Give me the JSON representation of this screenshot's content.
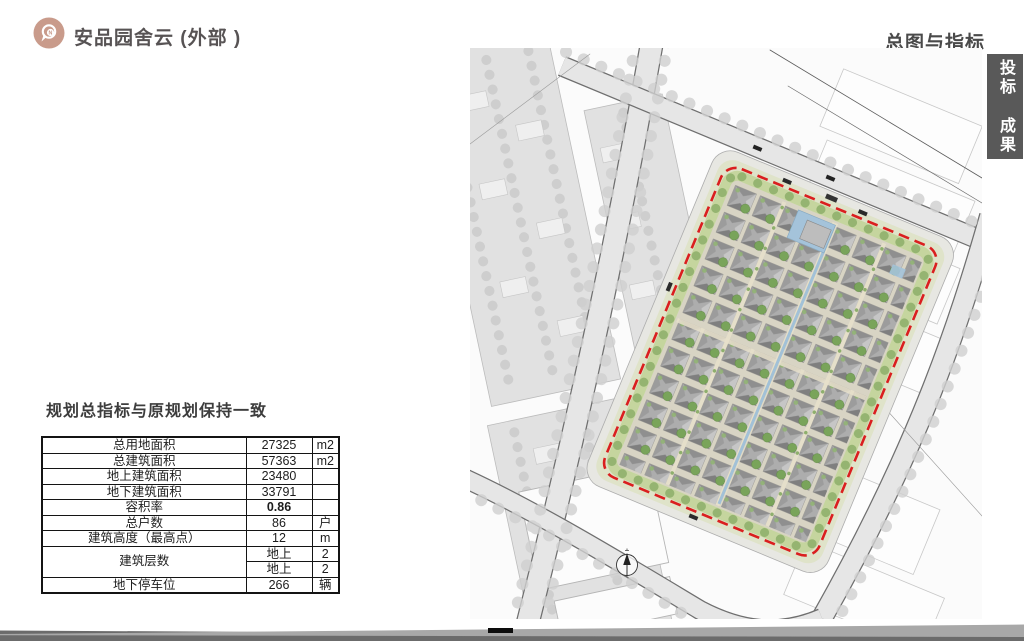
{
  "header": {
    "logo": {
      "icon": "location-pin-icon",
      "badge_letter": "N",
      "color": "#c99b8b"
    },
    "app_title": "安品园舍云 (外部 )",
    "section_title": "总图与指标",
    "side_tab": {
      "label": "投标 成果",
      "color": "#595959"
    }
  },
  "indicators": {
    "title": "规划总指标与原规划保持一致",
    "rows": [
      {
        "label": "总用地面积",
        "value": "27325",
        "unit": "m2"
      },
      {
        "label": "总建筑面积",
        "value": "57363",
        "unit": "m2"
      },
      {
        "label": "地上建筑面积",
        "value": "23480",
        "unit": ""
      },
      {
        "label": "地下建筑面积",
        "value": "33791",
        "unit": ""
      },
      {
        "label": "容积率",
        "value": "0.86",
        "unit": "",
        "bold": true
      },
      {
        "label": "总户数",
        "value": "86",
        "unit": "户"
      },
      {
        "label": "建筑高度（最高点）",
        "value": "12",
        "unit": "m"
      },
      {
        "label": "建筑层数",
        "value": "地上",
        "unit": "2",
        "rowspan": 2
      },
      {
        "merge_with_prev": true,
        "label": "",
        "value": "地上",
        "unit": "2"
      },
      {
        "label": "地下停车位",
        "value": "266",
        "unit": "辆"
      }
    ]
  },
  "site_plan": {
    "type": "master-plan",
    "boundary": "red-dashed-site-boundary",
    "compass": "north-arrow",
    "colors": {
      "site_boundary": "#da1f1f",
      "roof_gray": "#adadad",
      "tree_green": "#79a45a",
      "perimeter_green": "#c3d49c",
      "water_blue": "#a4c3da",
      "road_gray": "#e6e6e6",
      "context_block_gray": "#e1e1e1"
    }
  }
}
